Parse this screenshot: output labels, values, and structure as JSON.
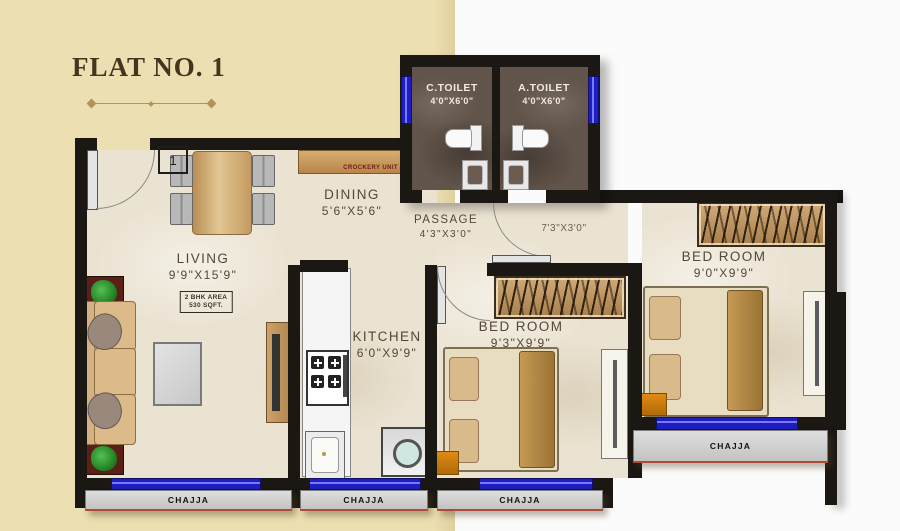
{
  "title": "FLAT NO. 1",
  "rooms": {
    "living": {
      "name": "LIVING",
      "dim": "9'9\"X15'9\""
    },
    "dining": {
      "name": "DINING",
      "dim": "5'6\"X5'6\""
    },
    "kitchen": {
      "name": "KITCHEN",
      "dim": "6'0\"X9'9\""
    },
    "passage": {
      "name": "PASSAGE",
      "dim": "4'3\"X3'0\""
    },
    "corridor": {
      "dim": "7'3\"X3'0\""
    },
    "bedroom1": {
      "name": "BED ROOM",
      "dim": "9'3\"X9'9\""
    },
    "bedroom2": {
      "name": "BED ROOM",
      "dim": "9'0\"X9'9\""
    },
    "c_toilet": {
      "name": "C.TOILET",
      "dim": "4'0\"X6'0\""
    },
    "a_toilet": {
      "name": "A.TOILET",
      "dim": "4'0\"X6'0\""
    }
  },
  "labels": {
    "chajja": "CHAJJA",
    "crockery_unit": "CROCKERY UNIT",
    "area_note_line1": "2 BHK AREA",
    "area_note_line2": "530 SQFT.",
    "entrance_door_number": "1"
  },
  "colors": {
    "background_left": "#ecdfb2",
    "background_right": "#fbfbfb",
    "wall": "#1b1713",
    "floor": "#ebe3d2",
    "window_blue": "#1d1dc0",
    "chajja_gray": "#cccccc",
    "chajja_red_line": "#b04a33",
    "toilet_floor": "#5f5248",
    "furniture_wood": "#c59a60",
    "title_brown": "#46341f",
    "plant_green": "#2e9e2e"
  }
}
